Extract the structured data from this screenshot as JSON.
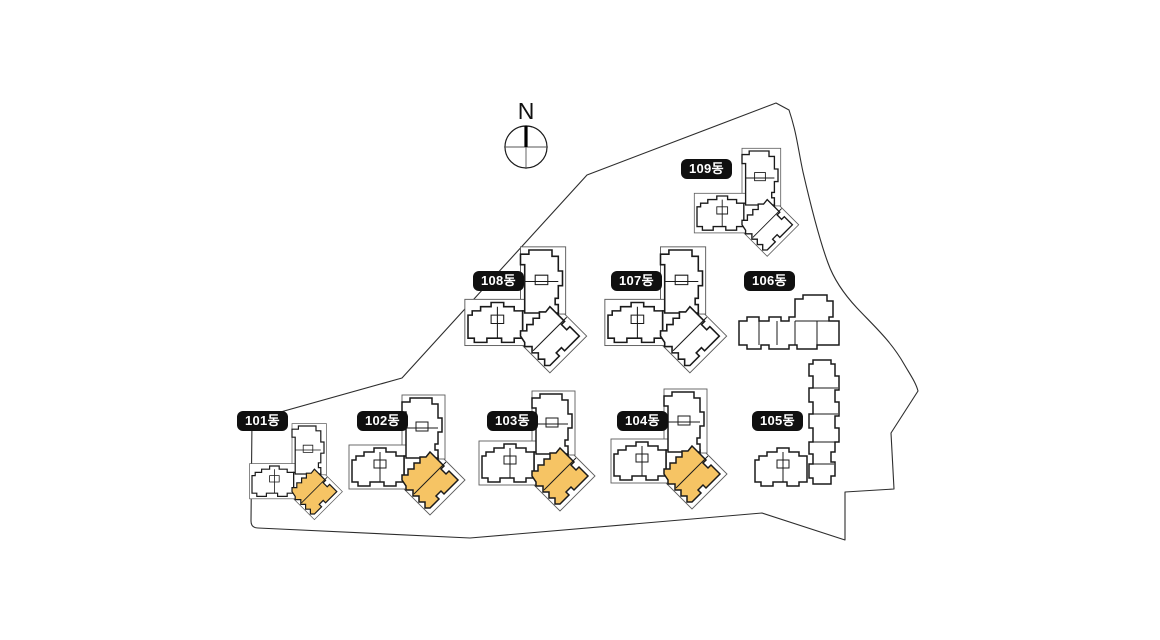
{
  "compass": {
    "label": "N"
  },
  "colors": {
    "background": "#ffffff",
    "building_outline": "#1a1a1a",
    "backdrop_outline": "#5c5c5c",
    "boundary_outline": "#2d2d2d",
    "highlight_fill": "#F6C464",
    "label_background": "#101010",
    "label_text": "#ffffff"
  },
  "buildings": [
    {
      "id": "101",
      "label": "101동",
      "highlighted": true
    },
    {
      "id": "102",
      "label": "102동",
      "highlighted": true
    },
    {
      "id": "103",
      "label": "103동",
      "highlighted": true
    },
    {
      "id": "104",
      "label": "104동",
      "highlighted": true
    },
    {
      "id": "105",
      "label": "105동",
      "highlighted": false
    },
    {
      "id": "106",
      "label": "106동",
      "highlighted": false
    },
    {
      "id": "107",
      "label": "107동",
      "highlighted": false
    },
    {
      "id": "108",
      "label": "108동",
      "highlighted": false
    },
    {
      "id": "109",
      "label": "109동",
      "highlighted": false
    }
  ]
}
